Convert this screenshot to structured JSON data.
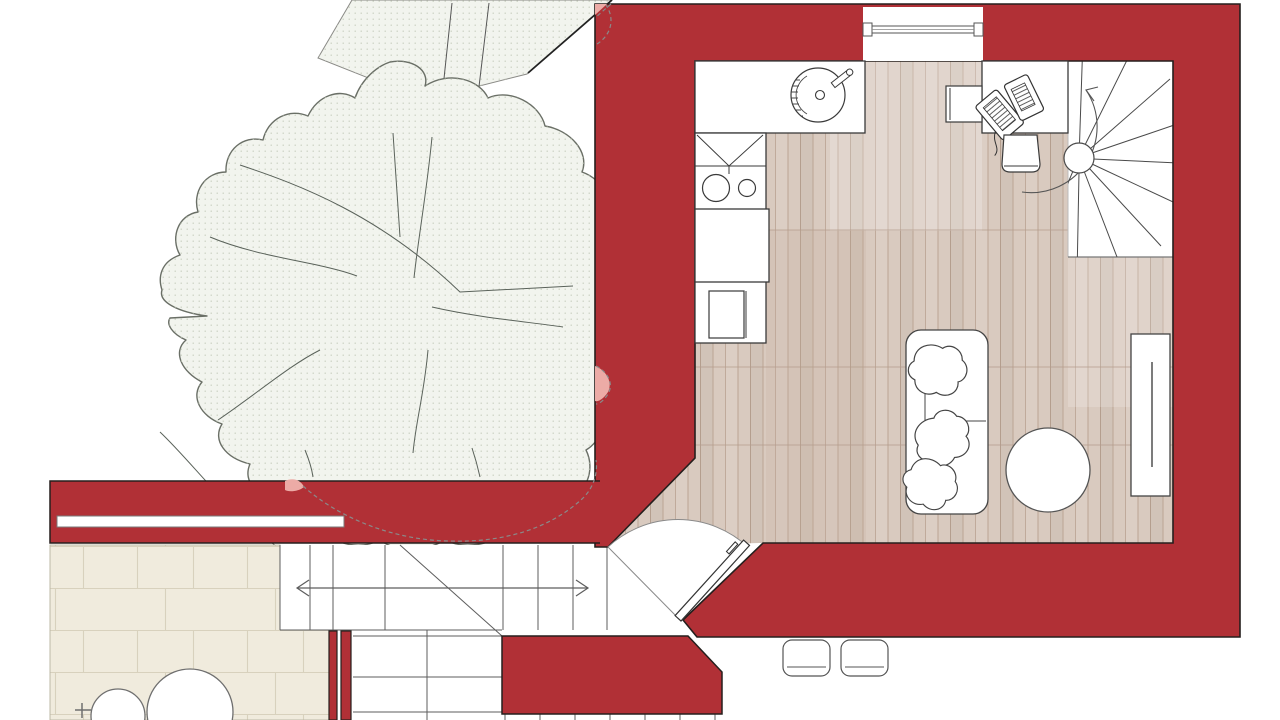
{
  "title": "apartment-ground-floor-plan",
  "colors": {
    "wall": "#b13036",
    "wallOutline": "#251f1d",
    "floor": "#d9cabf",
    "floorLine": "#a98f7e",
    "floorSeam": "#b49c8d",
    "paving": "#f0ebdd",
    "pavingLine": "#d8d1bd",
    "canopy": "#f2f4ee",
    "canopyDot": "#c6cdbd",
    "canopyOutline": "#6a6f66",
    "overlapPink": "#ecaba6",
    "ink": "#3a3a3a",
    "lightInk": "#777777",
    "white": "#ffffff"
  },
  "plan": {
    "building_items": [
      "main-room",
      "entry-door",
      "spiral-staircase",
      "top-window",
      "wall-slot-window"
    ],
    "kitchen_items": [
      "counter",
      "round-sink",
      "faucet",
      "corner-cabinet",
      "two-burner-stove",
      "base-cabinet",
      "appliance"
    ],
    "living_items": [
      "sofa",
      "pillow",
      "pillow",
      "pillow",
      "coffee-table",
      "sideboard"
    ],
    "work_items": [
      "desk",
      "laptop",
      "desk-chair",
      "side-stool"
    ],
    "outside_items": [
      "tree-canopy",
      "neighbor-roof",
      "exterior-stairs",
      "direction-arrow",
      "terrace-paving",
      "terrace-table",
      "terrace-stool",
      "garden-wall",
      "partition-wall",
      "stair-block",
      "outdoor-stool",
      "outdoor-stool"
    ]
  }
}
